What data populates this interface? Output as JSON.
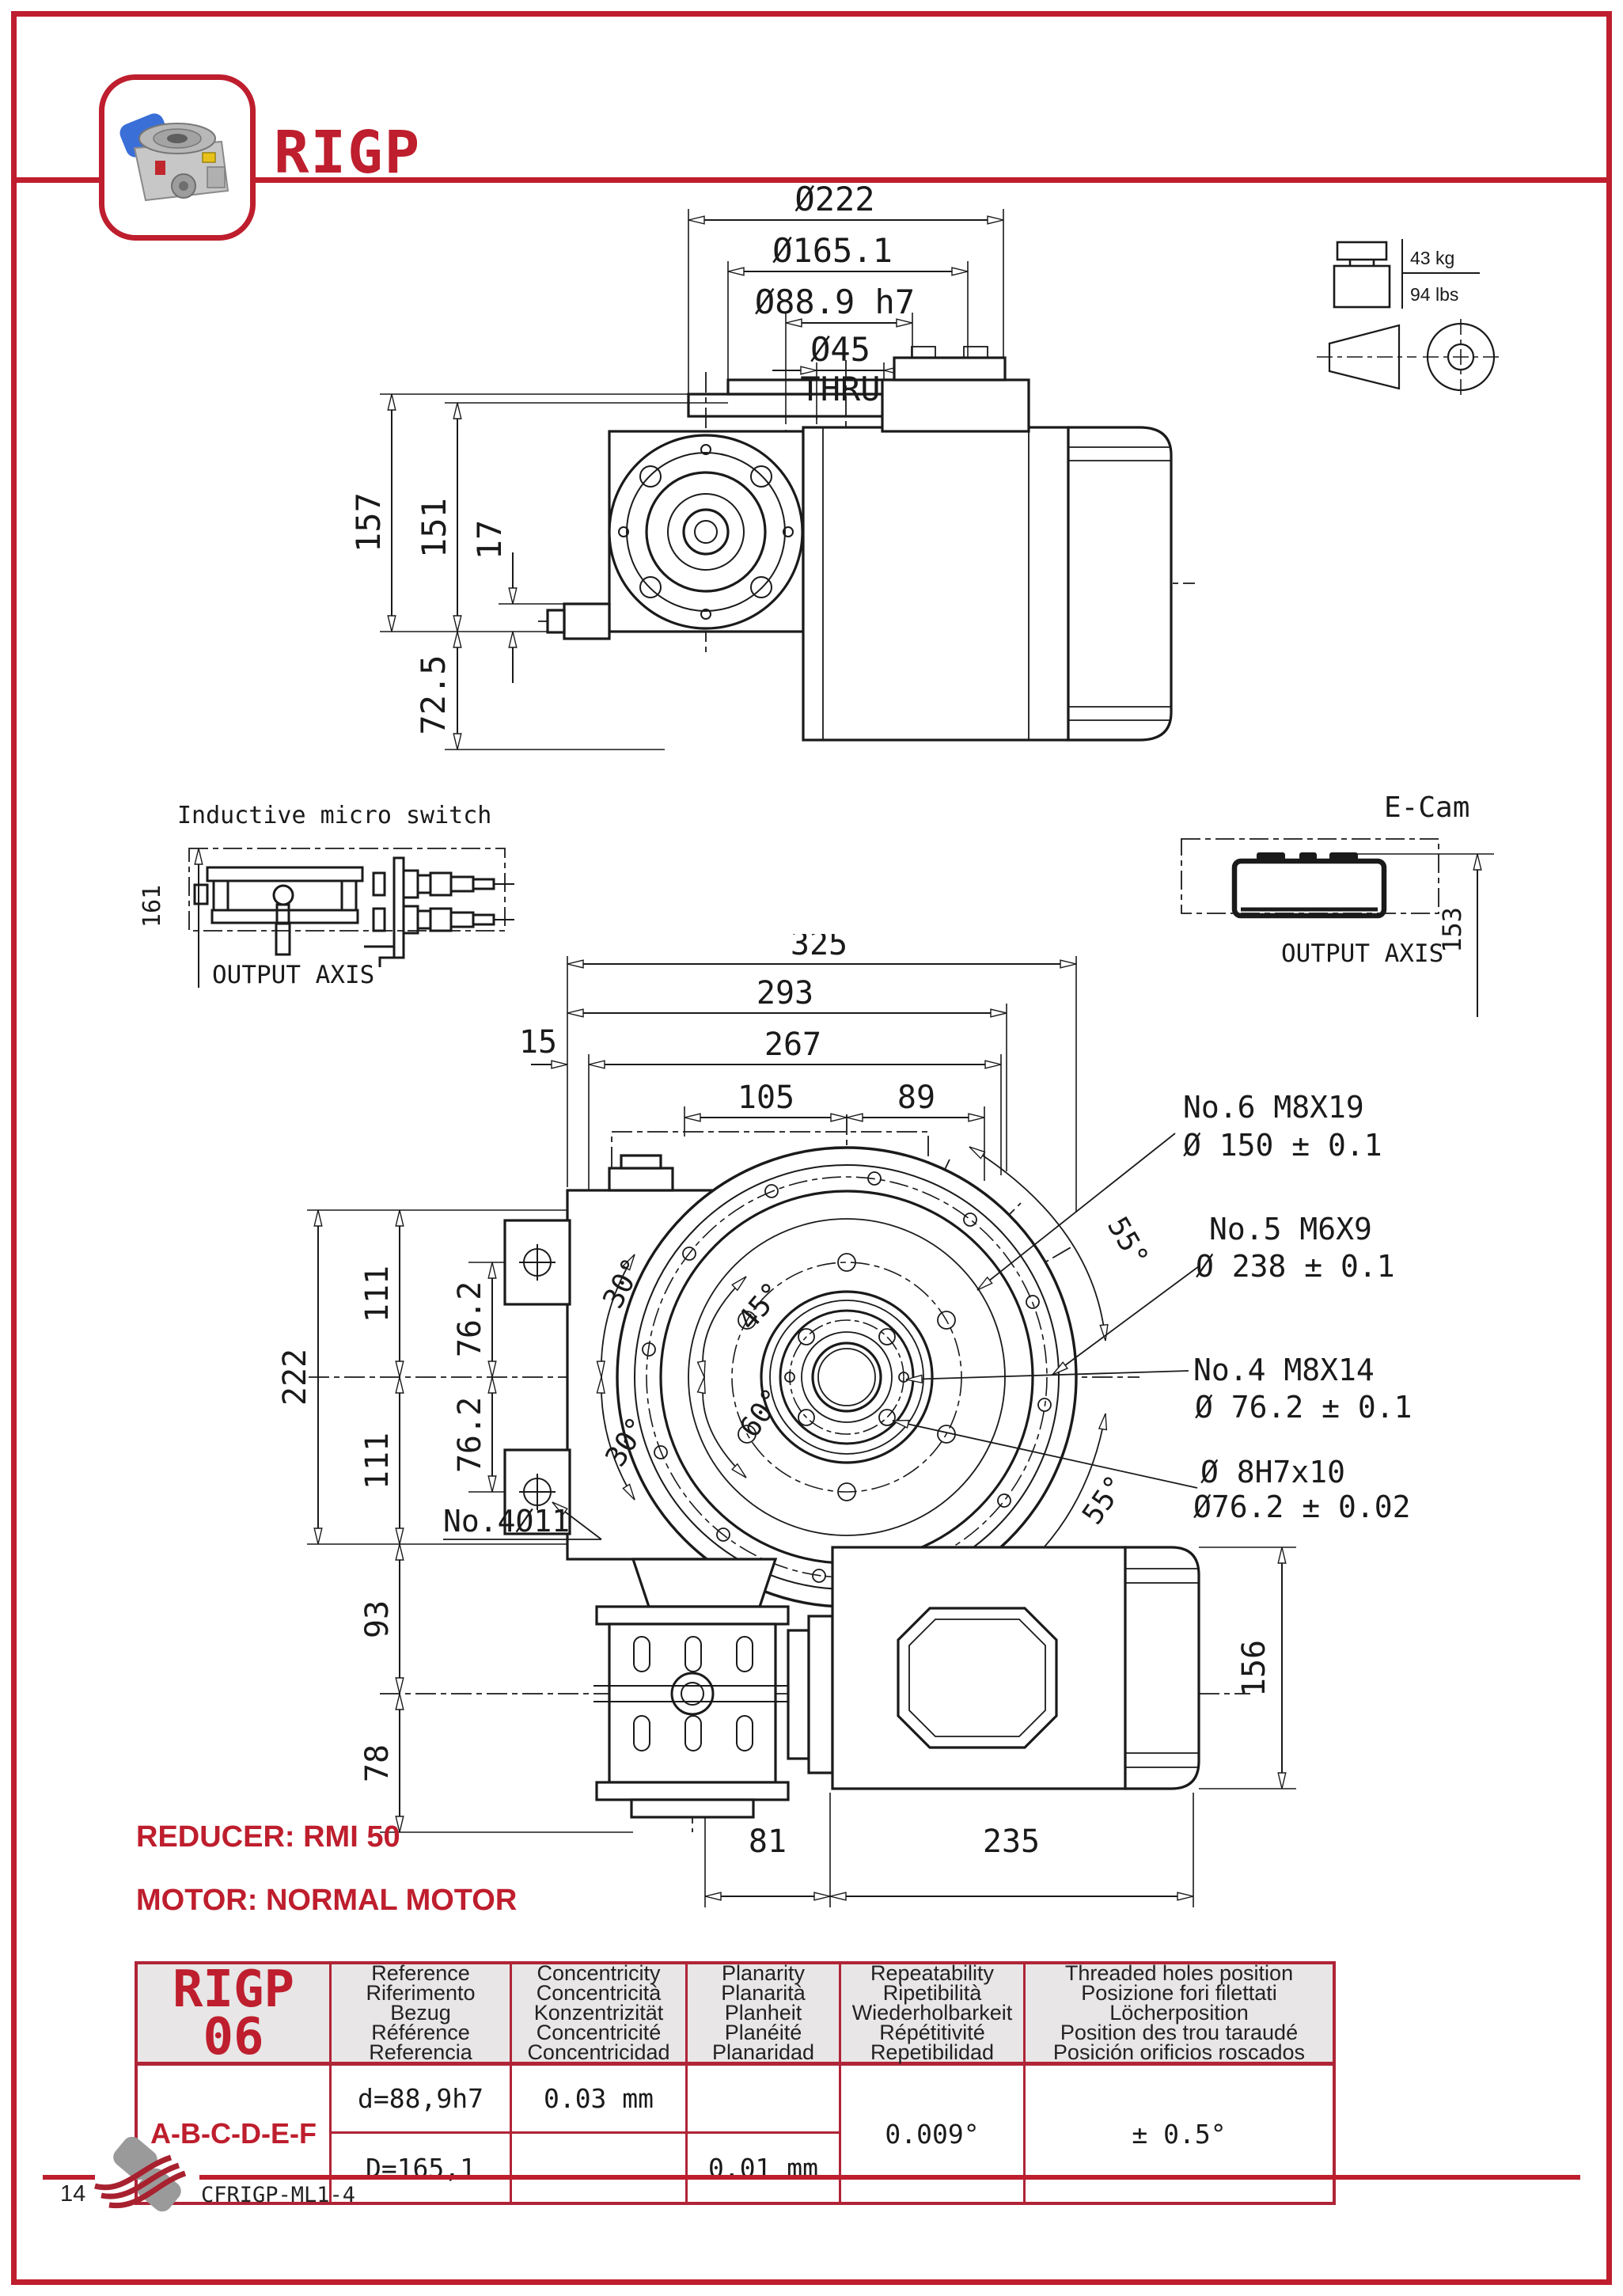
{
  "page": {
    "title": "RIGP",
    "page_number": "14",
    "doc_code": "CFRIGP-ML1-4"
  },
  "colors": {
    "accent": "#be1e2d",
    "table_border": "#b02437",
    "header_bg": "#e8e6e6",
    "line": "#1a1a1a"
  },
  "side_view": {
    "dia_222": "Ø222",
    "dia_165": "Ø165.1",
    "dia_889": "Ø88.9 h7",
    "dia_45": "Ø45",
    "thru": "THRU",
    "h_157": "157",
    "h_151": "151",
    "h_17": "17",
    "h_725": "72.5"
  },
  "weight": {
    "kg": "43 kg",
    "lbs": "94 lbs"
  },
  "micro_switch": {
    "title": "Inductive micro switch",
    "dim_161": "161",
    "axis_label": "OUTPUT AXIS"
  },
  "e_cam": {
    "title": "E-Cam",
    "dim_153": "153",
    "axis_label": "OUTPUT AXIS"
  },
  "front_view": {
    "w_325": "325",
    "w_293": "293",
    "w_267": "267",
    "w_15": "15",
    "w_105": "105",
    "w_89": "89",
    "h_222": "222",
    "h_111a": "111",
    "h_762a": "76.2",
    "h_762b": "76.2",
    "h_111b": "111",
    "h_93": "93",
    "h_78": "78",
    "w_81": "81",
    "w_235": "235",
    "h_156": "156",
    "ang_30a": "30°",
    "ang_30b": "30°",
    "ang_45": "45°",
    "ang_60": "60°",
    "ang_55a": "55°",
    "ang_55b": "55°",
    "note_no6_line1": "No.6 M8X19",
    "note_no6_line2": "Ø 150 ± 0.1",
    "note_no5_line1": "No.5  M6X9",
    "note_no5_line2": "Ø 238 ± 0.1",
    "note_no4_line1": "No.4 M8X14",
    "note_no4_line2": "Ø 76.2 ± 0.1",
    "note_pin_line1": "Ø 8H7x10",
    "note_pin_line2": "Ø76.2 ± 0.02",
    "note_holes": "No.4Ø11"
  },
  "notes": {
    "reducer": "REDUCER: RMI 50",
    "motor": "MOTOR: NORMAL MOTOR"
  },
  "spec_table": {
    "model_line1": "RIGP",
    "model_line2": "06",
    "columns": [
      {
        "lines": [
          "Reference",
          "Riferimento",
          "Bezug",
          "Référence",
          "Referencia"
        ]
      },
      {
        "lines": [
          "Concentricity",
          "Concentricità",
          "Konzentrizität",
          "Concentricité",
          "Concentricidad"
        ]
      },
      {
        "lines": [
          "Planarity",
          "Planarità",
          "Planheit",
          "Planéité",
          "Planaridad"
        ]
      },
      {
        "lines": [
          "Repeatability",
          "Ripetibilità",
          "Wiederholbarkeit",
          "Répétitivité",
          "Repetibilidad"
        ]
      },
      {
        "lines": [
          "Threaded holes position",
          "Posizione fori filettati",
          "Löcherposition",
          "Position des trou taraudé",
          "Posición orificios roscados"
        ]
      }
    ],
    "row_label": "A-B-C-D-E-F",
    "rows": [
      {
        "reference": "d=88,9h7",
        "concentricity": "0.03 mm",
        "planarity": ""
      },
      {
        "reference": "D=165,1",
        "concentricity": "",
        "planarity": "0.01 mm"
      }
    ],
    "repeatability_value": "0.009°",
    "threaded_value": "± 0.5°"
  }
}
